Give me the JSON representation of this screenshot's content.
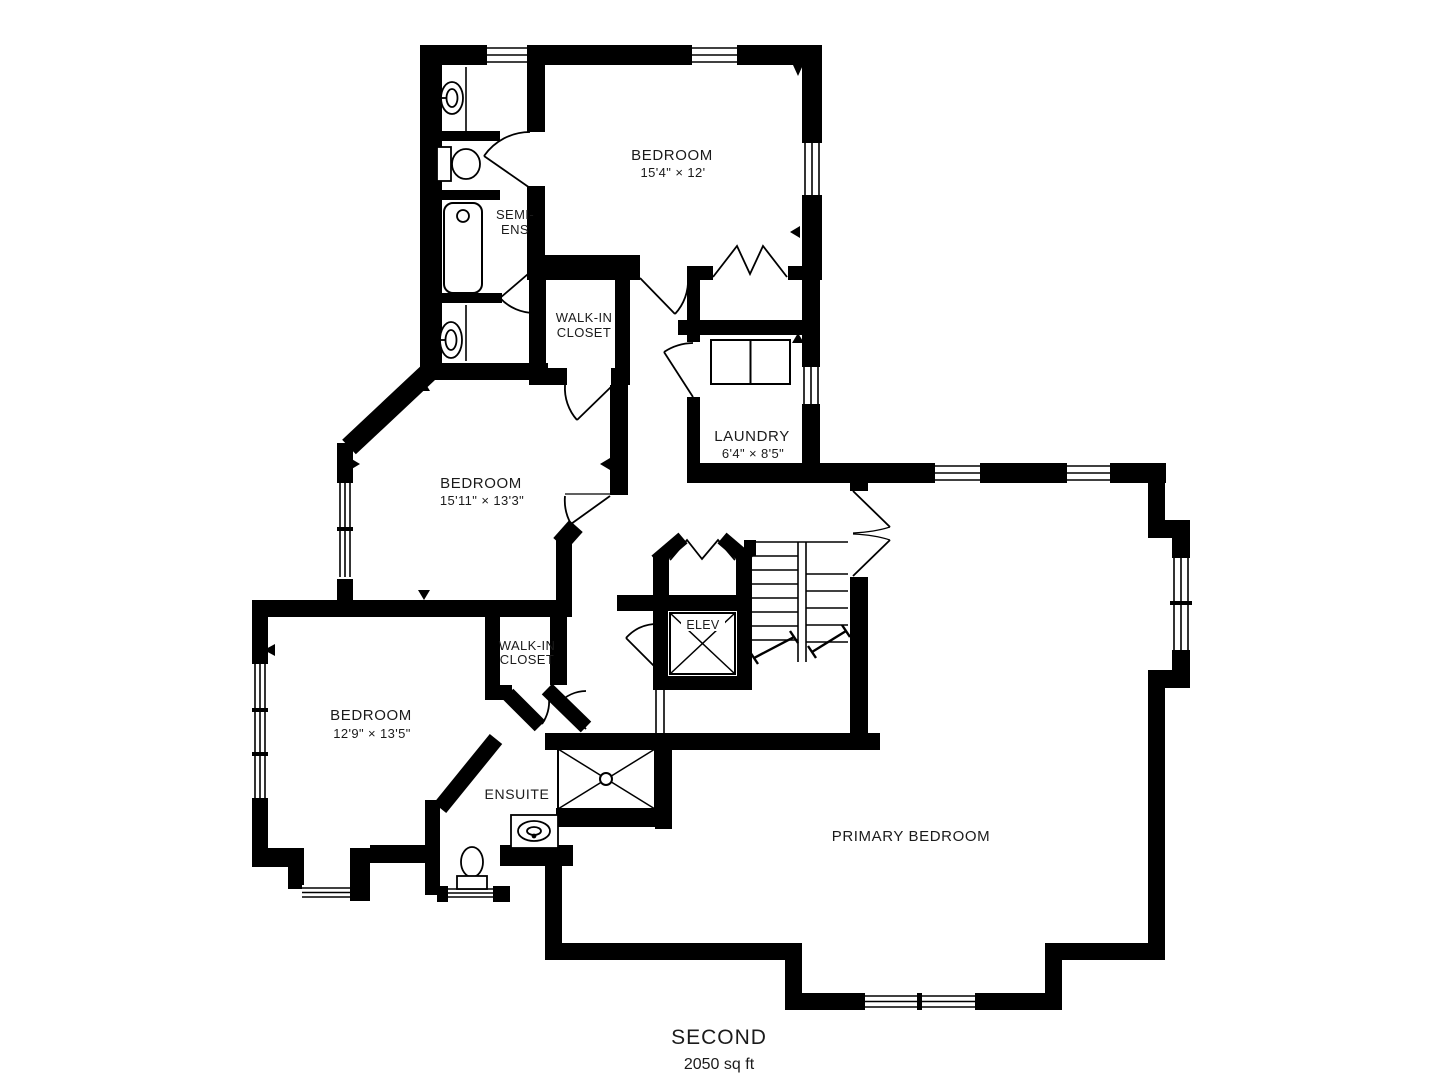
{
  "plan": {
    "title": {
      "floor": "SECOND",
      "area": "2050 sq ft"
    },
    "rooms": {
      "bedroom_top": {
        "label": "BEDROOM",
        "dims": "15'4\" × 12'"
      },
      "semi_ens": {
        "line1": "SEMI-",
        "line2": "ENS"
      },
      "walk_in_closet_top": {
        "line1": "WALK-IN",
        "line2": "CLOSET"
      },
      "bedroom_middle": {
        "label": "BEDROOM",
        "dims": "15'11\" × 13'3\""
      },
      "laundry": {
        "label": "LAUNDRY",
        "dims": "6'4\" × 8'5\""
      },
      "elevator": {
        "label": "ELEV"
      },
      "walk_in_closet_lower": {
        "line1": "WALK-IN",
        "line2": "CLOSET"
      },
      "bedroom_lower": {
        "label": "BEDROOM",
        "dims": "12'9\" × 13'5\""
      },
      "ensuite": {
        "label": "ENSUITE"
      },
      "primary_bedroom": {
        "label": "PRIMARY BEDROOM"
      }
    },
    "colors": {
      "walls": "#000000",
      "background": "#ffffff",
      "text": "#1b1b1b"
    }
  }
}
